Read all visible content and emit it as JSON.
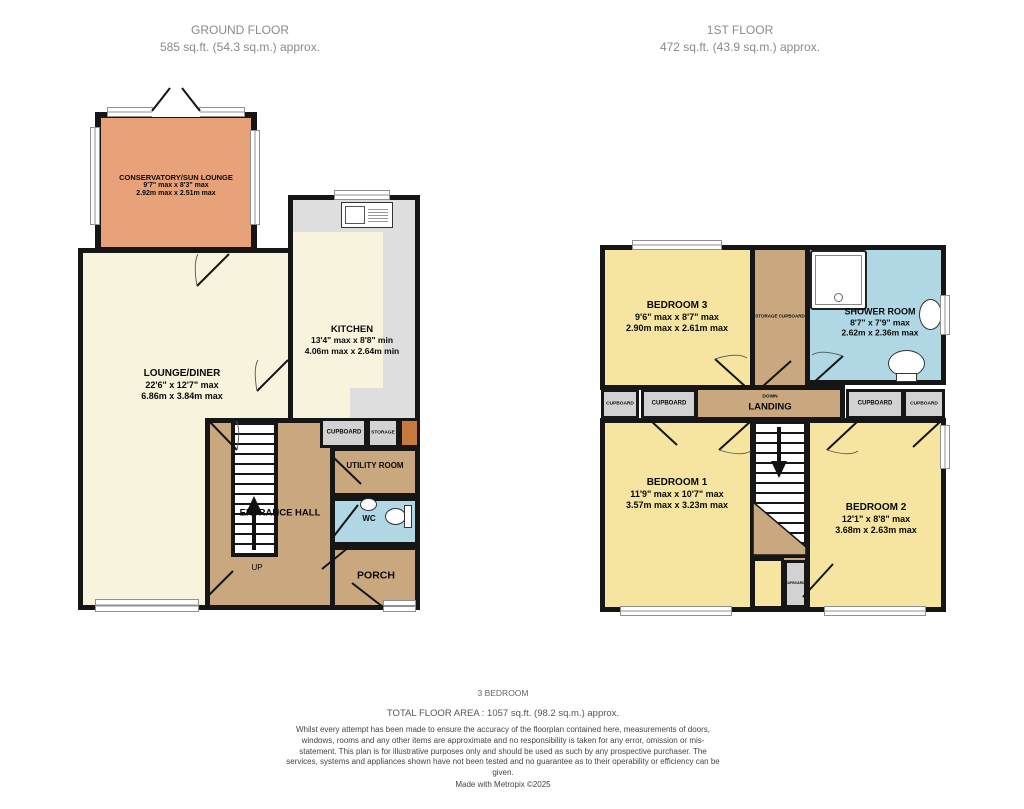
{
  "ground_floor": {
    "title": "GROUND FLOOR",
    "subtitle": "585 sq.ft. (54.3 sq.m.) approx.",
    "stairs_label": "UP",
    "rooms": {
      "conservatory": {
        "name": "CONSERVATORY/SUN LOUNGE",
        "imperial": "9'7\" max x 8'3\" max",
        "metric": "2.92m max x 2.51m max"
      },
      "lounge": {
        "name": "LOUNGE/DINER",
        "imperial": "22'6\" x 12'7\" max",
        "metric": "6.86m x 3.84m max"
      },
      "kitchen": {
        "name": "KITCHEN",
        "imperial": "13'4\" max x 8'8\" min",
        "metric": "4.06m max x 2.64m min"
      },
      "cupboard": {
        "name": "CUPBOARD"
      },
      "storage": {
        "name": "STORAGE"
      },
      "utility": {
        "name": "UTILITY ROOM"
      },
      "entrance_hall": {
        "name": "ENTRANCE HALL"
      },
      "wc": {
        "name": "WC"
      },
      "porch": {
        "name": "PORCH"
      }
    }
  },
  "first_floor": {
    "title": "1ST FLOOR",
    "subtitle": "472 sq.ft. (43.9 sq.m.) approx.",
    "stairs_label": "DOWN",
    "cupboard_label": "CUPBOARD",
    "rooms": {
      "bedroom3": {
        "name": "BEDROOM 3",
        "imperial": "9'6\" max x 8'7\" max",
        "metric": "2.90m max x 2.61m max"
      },
      "storage_cupboard": {
        "name": "STORAGE CUPBOARD"
      },
      "shower_room": {
        "name": "SHOWER ROOM",
        "imperial": "8'7\" x 7'9\" max",
        "metric": "2.62m x 2.36m max"
      },
      "landing": {
        "name": "LANDING"
      },
      "bedroom1": {
        "name": "BEDROOM 1",
        "imperial": "11'9\" max x 10'7\" max",
        "metric": "3.57m max x 3.23m max"
      },
      "bedroom2": {
        "name": "BEDROOM 2",
        "imperial": "12'1\" x 8'8\" max",
        "metric": "3.68m x 2.63m max"
      }
    }
  },
  "footer": {
    "property_type": "3 BEDROOM",
    "total_area": "TOTAL FLOOR AREA : 1057 sq.ft. (98.2 sq.m.) approx.",
    "disclaimer": "Whilst every attempt has been made to ensure the accuracy of the floorplan contained here, measurements of doors, windows, rooms and any other items are approximate and no responsibility is taken for any error, omission or mis-statement. This plan is for illustrative purposes only and should be used as such by any prospective purchaser. The services, systems and appliances shown have not been tested and no guarantee as to their operability or efficiency can be given.",
    "credit": "Made with Metropix ©2025"
  },
  "colors": {
    "wall": "#161616",
    "conservatory_orange": "#E8A279",
    "ground_cream": "#F8F3DC",
    "hall_tan": "#C9A87F",
    "bathroom_blue": "#AFD8E4",
    "bedroom_yellow": "#F6E5A0",
    "cupboard_gray": "#D2D2D2",
    "counter_gray": "#DEDEDE"
  }
}
